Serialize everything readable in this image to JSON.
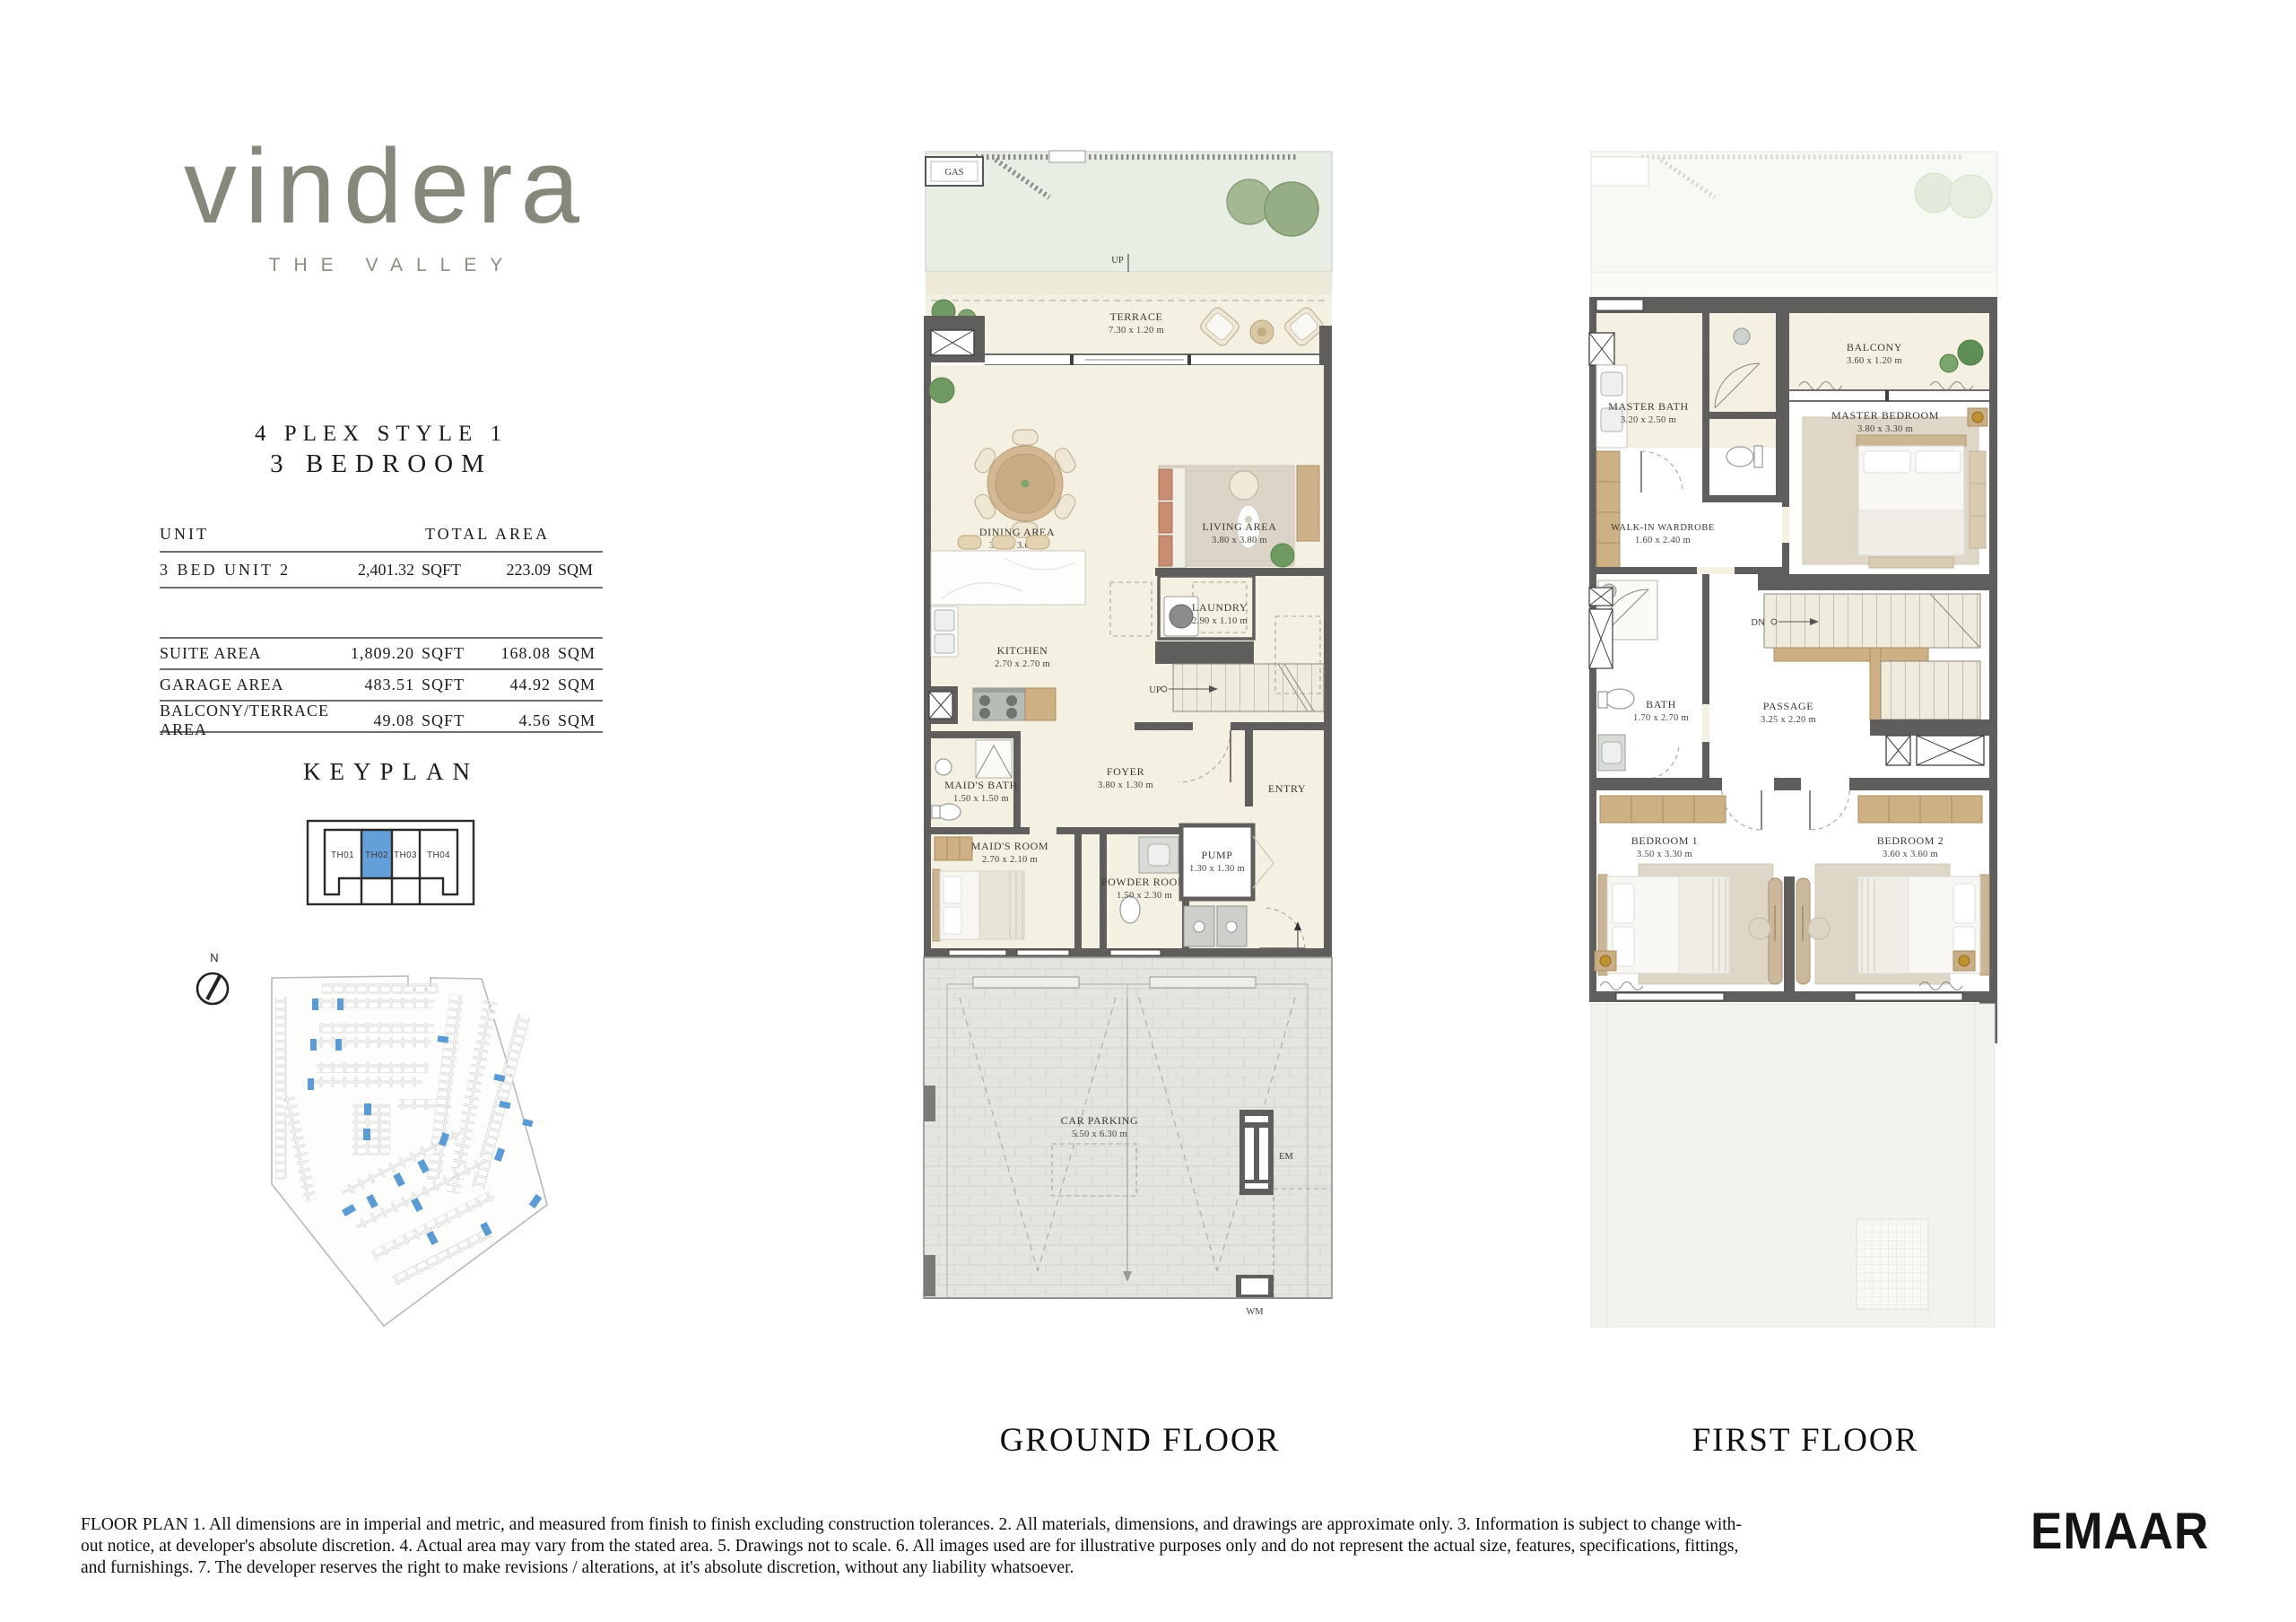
{
  "brand": {
    "logo": "vindera",
    "tagline": "THE VALLEY"
  },
  "header": {
    "line1": "4 PLEX STYLE 1",
    "line2": "3 BEDROOM"
  },
  "table": {
    "col_unit": "UNIT",
    "col_total": "TOTAL AREA",
    "unit_row": {
      "label": "3 BED UNIT 2",
      "sqft": "2,401.32",
      "sqft_u": "SQFT",
      "sqm": "223.09",
      "sqm_u": "SQM"
    },
    "rows": [
      {
        "label": "SUITE AREA",
        "sqft": "1,809.20",
        "sqft_u": "SQFT",
        "sqm": "168.08",
        "sqm_u": "SQM"
      },
      {
        "label": "GARAGE AREA",
        "sqft": "483.51",
        "sqft_u": "SQFT",
        "sqm": "44.92",
        "sqm_u": "SQM"
      },
      {
        "label": "BALCONY/TERRACE AREA",
        "sqft": "49.08",
        "sqft_u": "SQFT",
        "sqm": "4.56",
        "sqm_u": "SQM"
      }
    ]
  },
  "keyplan": {
    "title": "KEYPLAN",
    "units": [
      "TH01",
      "TH02",
      "TH03",
      "TH04"
    ],
    "highlighted_unit": "TH02",
    "highlight_color": "#64a0d8"
  },
  "compass": {
    "north": "N"
  },
  "gf": {
    "title": "GROUND FLOOR",
    "gas": "GAS",
    "up_terrace": "UP",
    "up_stairs": "UP",
    "up_garage": "UP",
    "em": "EM",
    "wm": "WM",
    "entry": "ENTRY",
    "rooms": {
      "terrace": {
        "name": "TERRACE",
        "dims": "7.30 x 1.20 m"
      },
      "dining": {
        "name": "DINING AREA",
        "dims": "3.40 x 3.60 m"
      },
      "living": {
        "name": "LIVING AREA",
        "dims": "3.80 x 3.80 m"
      },
      "kitchen": {
        "name": "KITCHEN",
        "dims": "2.70 x 2.70 m"
      },
      "laundry": {
        "name": "LAUNDRY",
        "dims": "2.90 x 1.10 m"
      },
      "foyer": {
        "name": "FOYER",
        "dims": "3.80 x 1.30 m"
      },
      "maids_bath": {
        "name": "MAID'S BATH",
        "dims": "1.50 x 1.50 m"
      },
      "maids_room": {
        "name": "MAID'S ROOM",
        "dims": "2.70 x 2.10 m"
      },
      "powder": {
        "name": "POWDER ROOM",
        "dims": "1.50 x 2.30 m"
      },
      "pump": {
        "name": "PUMP",
        "dims": "1.30 x 1.30 m"
      },
      "parking": {
        "name": "CAR PARKING",
        "dims": "5.50 x 6.30 m"
      }
    }
  },
  "ff": {
    "title": "FIRST FLOOR",
    "dn": "DN",
    "rooms": {
      "master_bath": {
        "name": "MASTER BATH",
        "dims": "3.20 x 2.50 m"
      },
      "balcony": {
        "name": "BALCONY",
        "dims": "3.60 x 1.20 m"
      },
      "master_bedroom": {
        "name": "MASTER BEDROOM",
        "dims": "3.80 x 3.30 m"
      },
      "wardrobe": {
        "name": "WALK-IN WARDROBE",
        "dims": "1.60 x 2.40 m"
      },
      "bath": {
        "name": "BATH",
        "dims": "1.70 x 2.70 m"
      },
      "passage": {
        "name": "PASSAGE",
        "dims": "3.25 x 2.20 m"
      },
      "bedroom1": {
        "name": "BEDROOM 1",
        "dims": "3.50 x 3.30 m"
      },
      "bedroom2": {
        "name": "BEDROOM 2",
        "dims": "3.60 x 3.60 m"
      }
    }
  },
  "disclaimer": {
    "line1": "FLOOR PLAN 1. All dimensions are in imperial and metric, and measured from finish to finish excluding construction tolerances. 2. All materials, dimensions, and drawings are approximate only. 3. Information is subject to change with-",
    "line2": "out notice, at developer's absolute discretion. 4. Actual area may vary from the stated area. 5. Drawings not to scale. 6. All images used are for illustrative purposes only and do not represent the actual size, features, specifications, fittings,",
    "line3": "and furnishings. 7. The developer reserves the right to make revisions / alterations, at it's absolute discretion, without any liability whatsoever."
  },
  "developer": {
    "logo": "EMAAR"
  }
}
